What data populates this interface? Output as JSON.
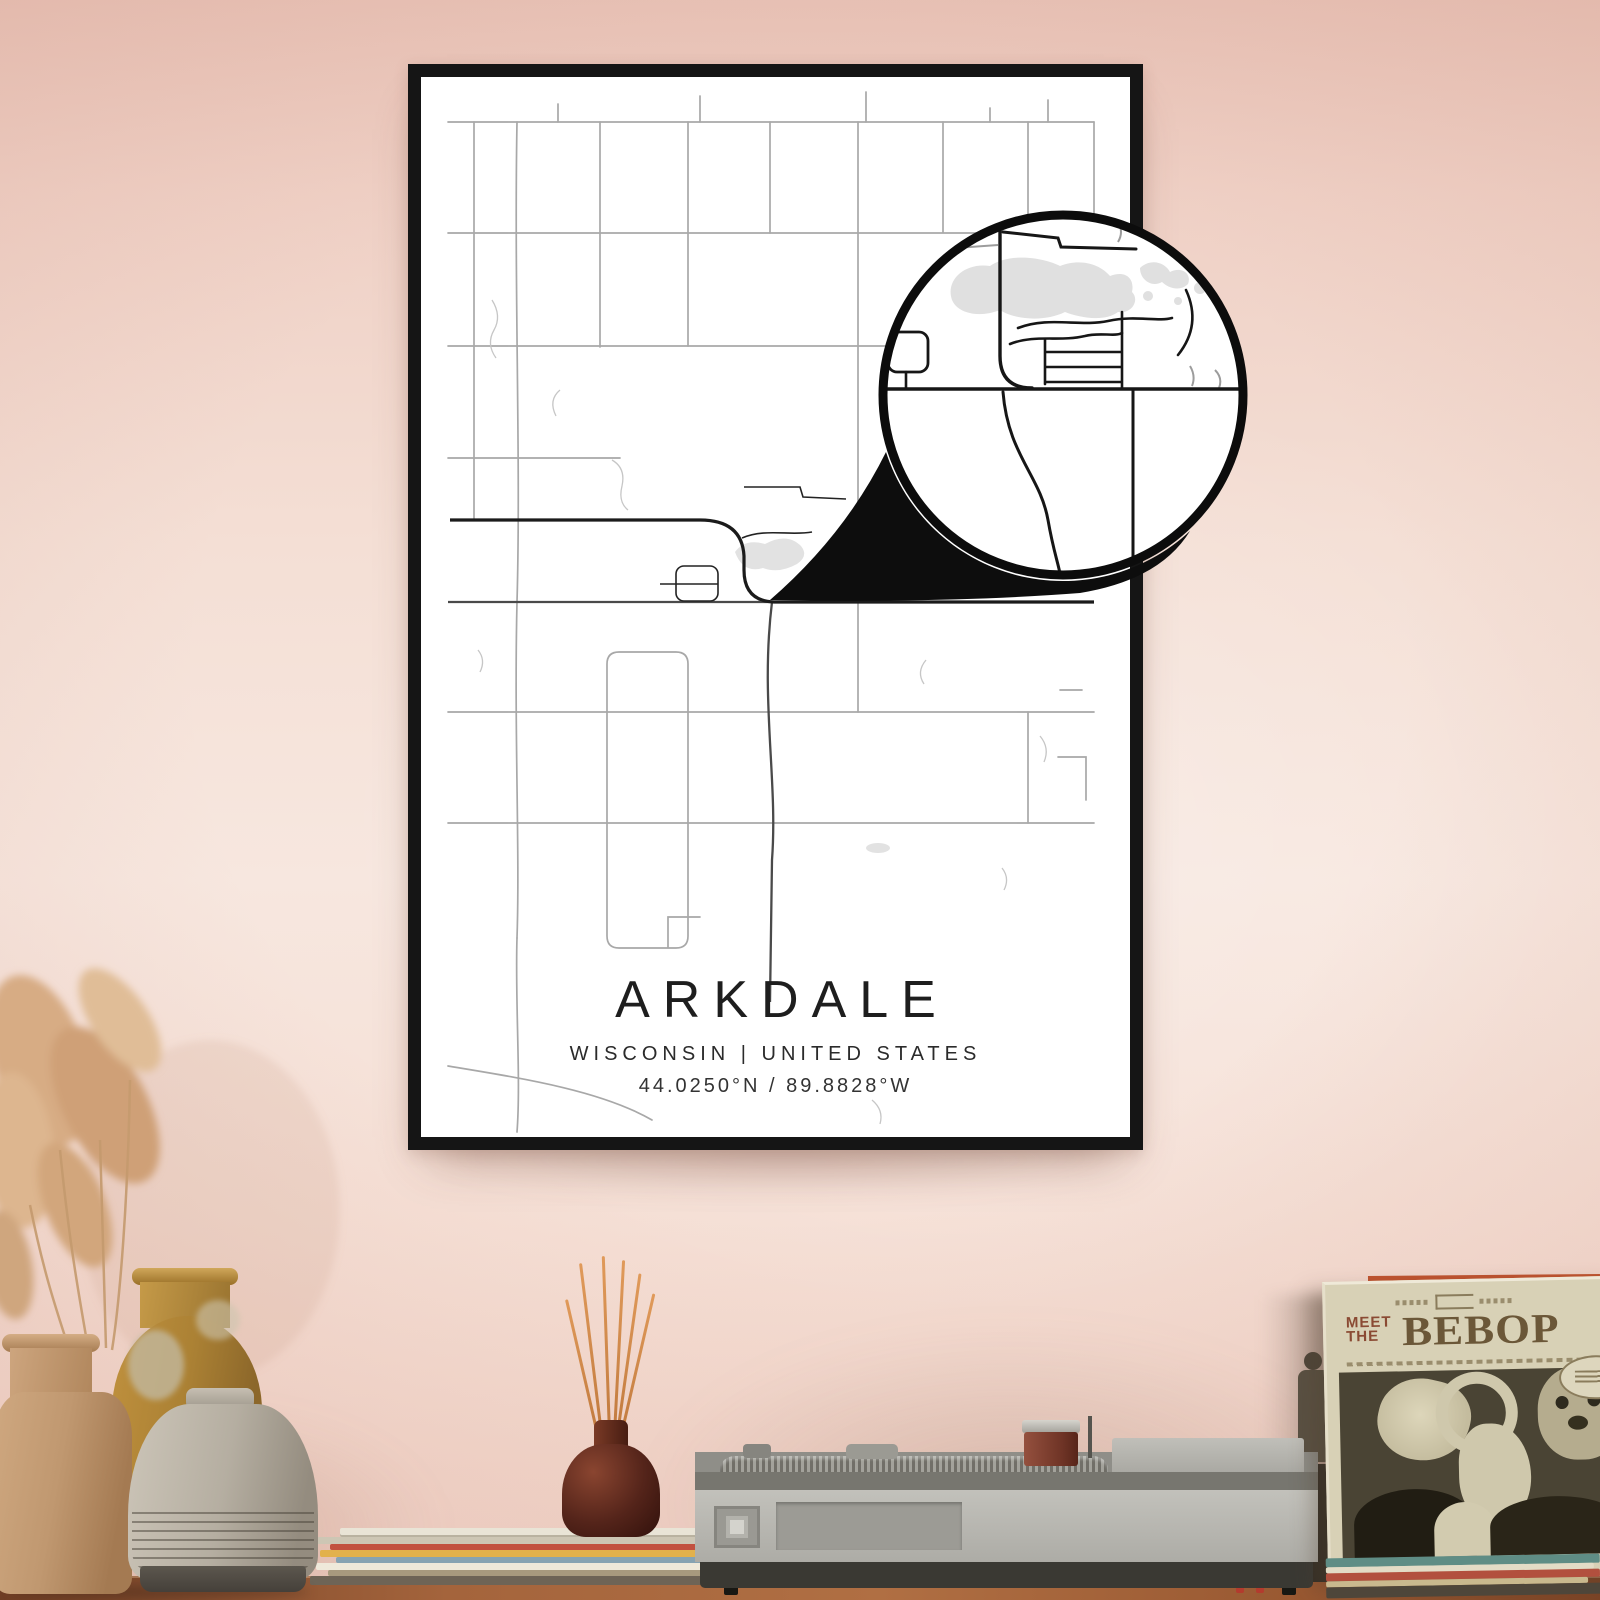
{
  "poster": {
    "title": "ARKDALE",
    "subtitle": "WISCONSIN | UNITED STATES",
    "coordinates": "44.0250°N / 89.8828°W",
    "frame_color": "#151515",
    "paper_color": "#ffffff",
    "road_color": "#a8a8a8",
    "highway_color": "#1b1b1b",
    "water_color": "#e2e2e2"
  },
  "callout": {
    "type": "magnifier-detail-circle",
    "border_color": "#0c0c0c",
    "background": "#ffffff",
    "water_color": "#e0e0e0"
  },
  "sleeve": {
    "line1": "MEET",
    "line2": "THE",
    "title": "BEBOP",
    "background": "#d8d1b6",
    "title_color": "#6b5738",
    "accent_color": "#8a4a33",
    "photo_background": "#4a4434"
  },
  "wall": {
    "top_color": "#e8c2b6",
    "mid_color": "#f7e7df",
    "bottom_color": "#f1d4c9"
  },
  "shelf": {
    "wood_color": "#a4643c"
  },
  "decor_items": [
    "pampas-grass",
    "tan-vase",
    "ochre-vase",
    "gray-ribbed-vase",
    "reed-diffuser",
    "magazine-stack",
    "record-player",
    "cigarette-lighter",
    "record-sleeve"
  ]
}
